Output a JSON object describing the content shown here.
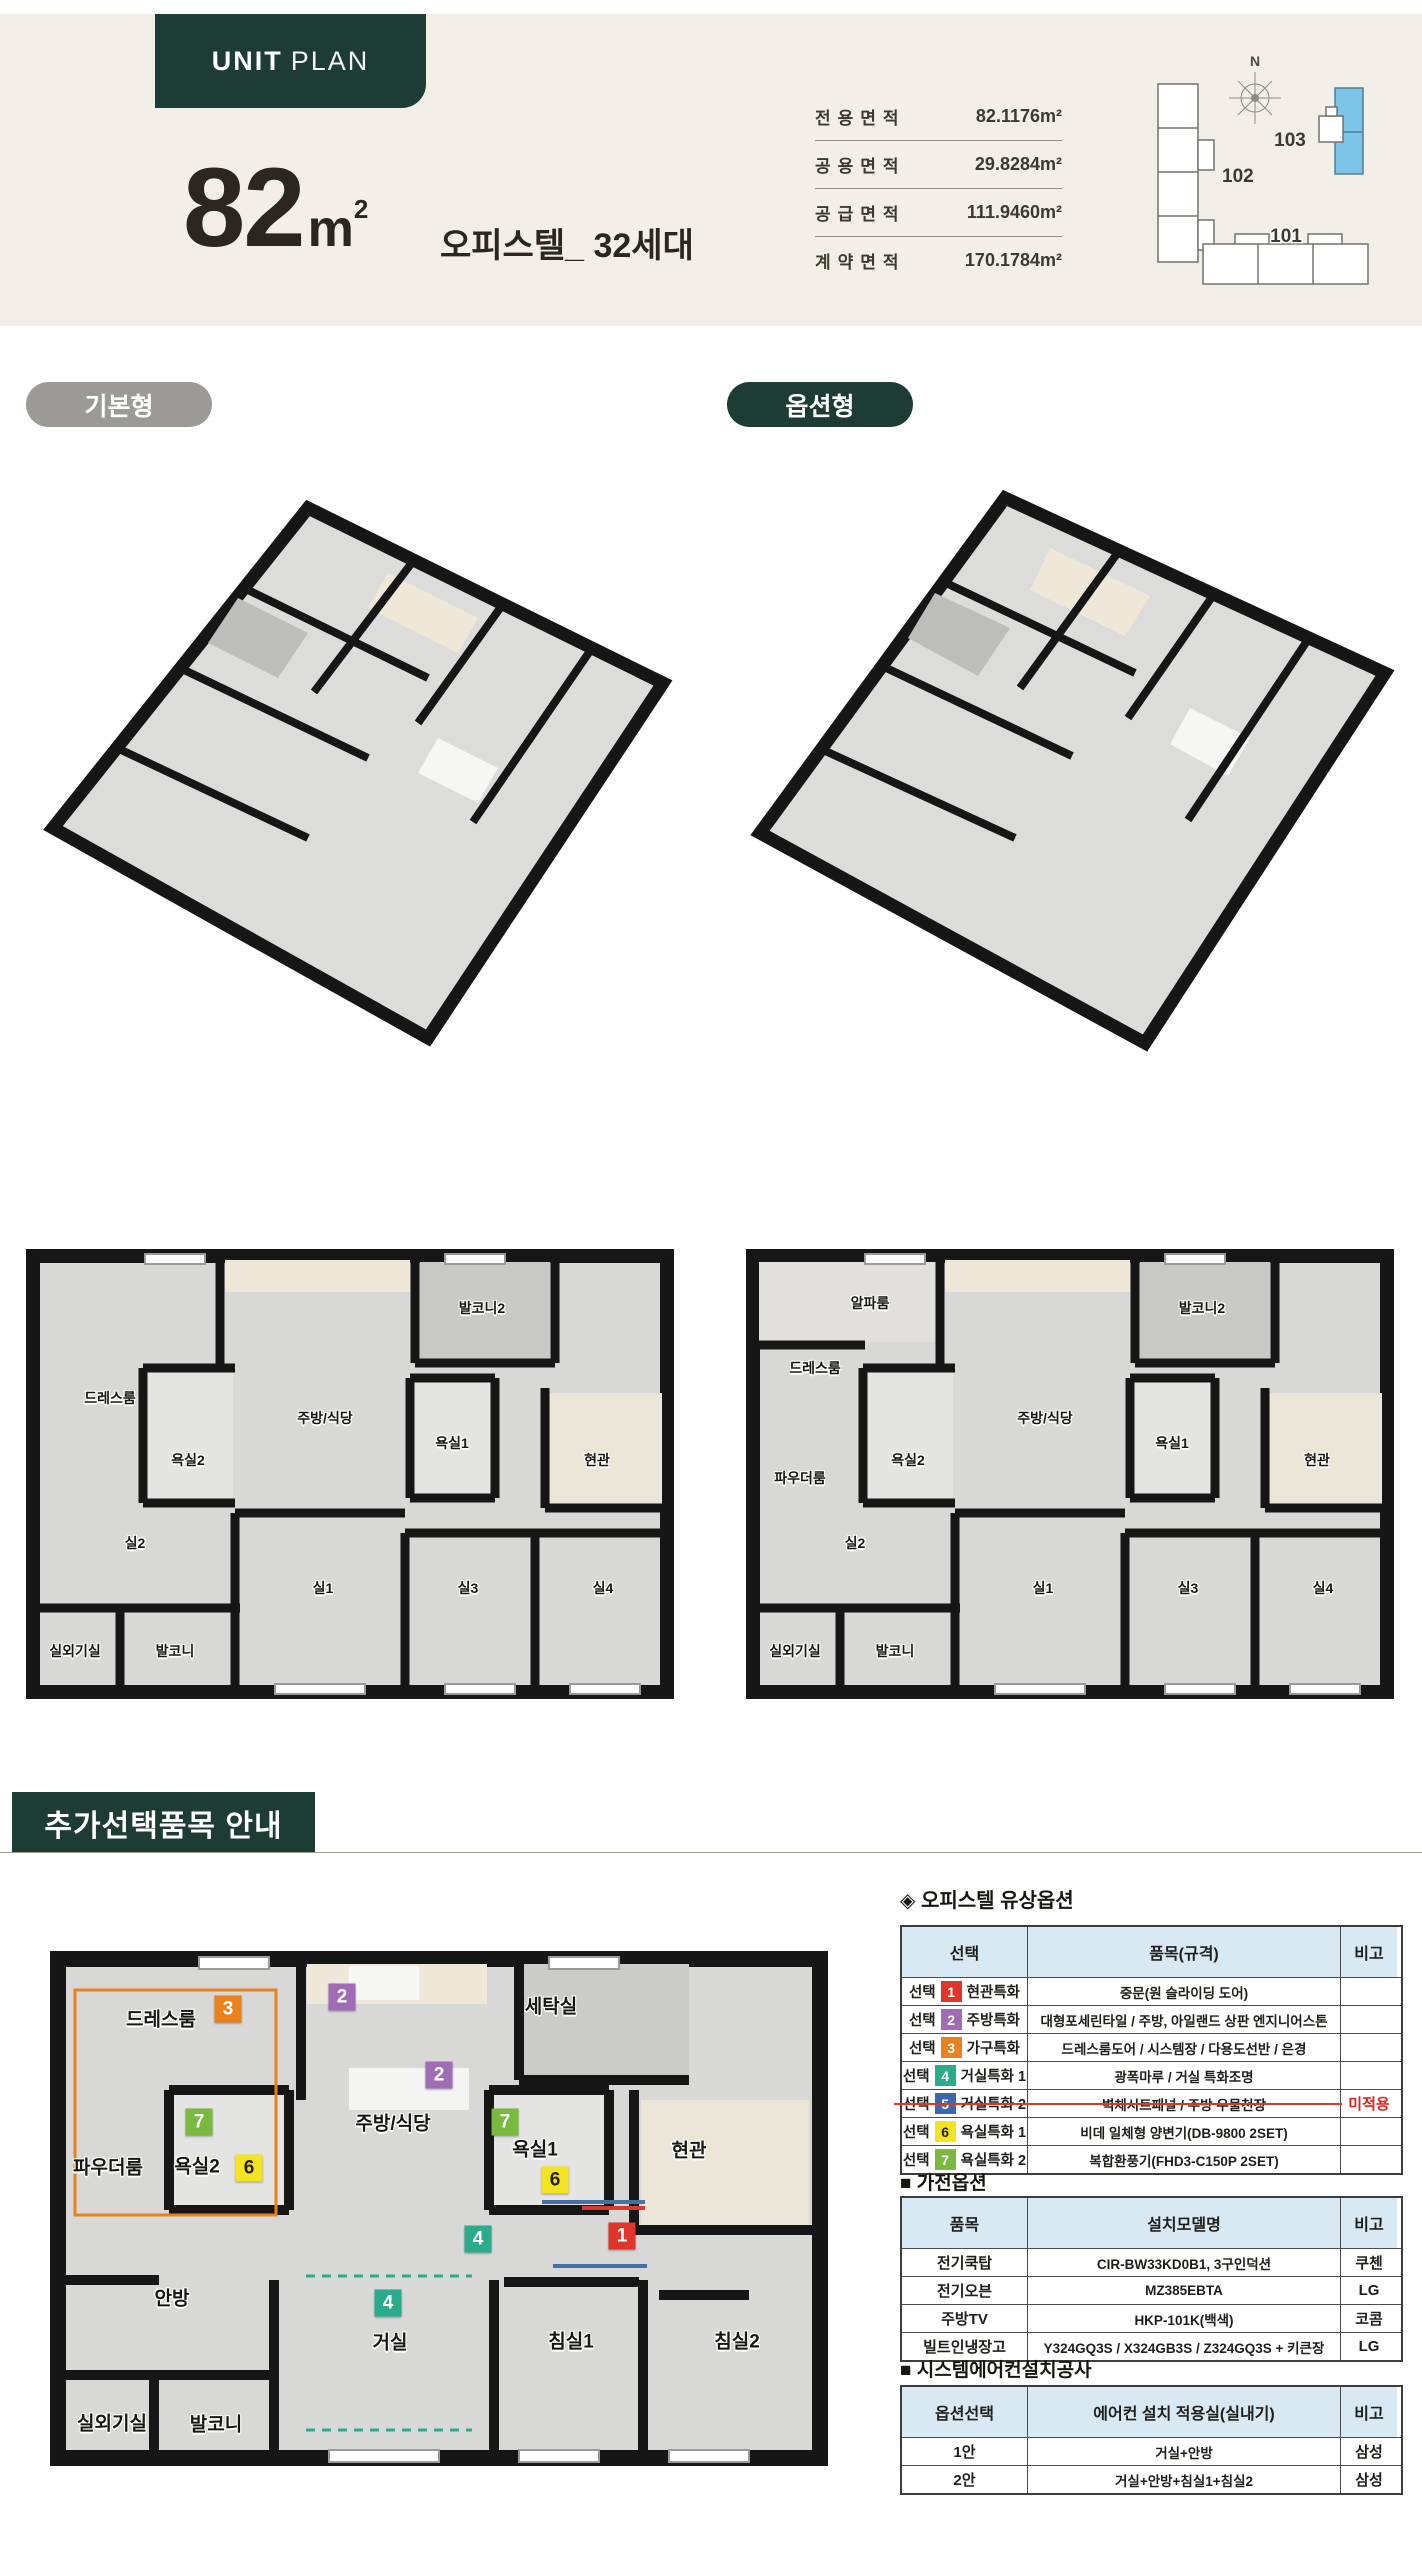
{
  "header": {
    "badge_bold": "UNIT",
    "badge_light": "PLAN",
    "size_number": "82",
    "size_unit": "m",
    "size_sup": "2",
    "subtitle": "오피스텔_ 32세대",
    "area_rows": [
      {
        "label": "전용면적",
        "value": "82.1176m²"
      },
      {
        "label": "공용면적",
        "value": "29.8284m²"
      },
      {
        "label": "공급면적",
        "value": "111.9460m²"
      },
      {
        "label": "계약면적",
        "value": "170.1784m²"
      }
    ],
    "site_map": {
      "north": "N",
      "b101": "101",
      "b102": "102",
      "b103": "103",
      "highlight_color": "#7cc5e8"
    }
  },
  "badges": {
    "basic": "기본형",
    "option": "옵션형"
  },
  "plan_basic": {
    "dress": "드레스룸",
    "balc2": "발코니2",
    "kitchen": "주방/식당",
    "bath2": "욕실2",
    "bath1": "욕실1",
    "entry": "현관",
    "r2": "실2",
    "r1": "실1",
    "r3": "실3",
    "r4": "실4",
    "ac": "실외기실",
    "balc": "발코니"
  },
  "plan_option": {
    "alpha": "알파룸",
    "dress": "드레스룸",
    "powder": "파우더룸",
    "balc2": "발코니2",
    "kitchen": "주방/식당",
    "bath2": "욕실2",
    "bath1": "욕실1",
    "entry": "현관",
    "r2": "실2",
    "r1": "실1",
    "r3": "실3",
    "r4": "실4",
    "ac": "실외기실",
    "balc": "발코니"
  },
  "section": {
    "title": "추가선택품목 안내"
  },
  "aplan": {
    "dress": "드레스룸",
    "laundry": "세탁실",
    "kitchen": "주방/식당",
    "powder": "파우더룸",
    "bath2": "욕실2",
    "bath1": "욕실1",
    "entry": "현관",
    "master": "안방",
    "living": "거실",
    "bed1": "침실1",
    "bed2": "침실2",
    "ac": "실외기실",
    "balc": "발코니",
    "m1": "1",
    "m2": "2",
    "m3": "3",
    "m4": "4",
    "m6": "6",
    "m7": "7"
  },
  "marker_colors": {
    "1": "#e0352b",
    "2": "#a06cb5",
    "3": "#e8821e",
    "4": "#2aab8a",
    "5": "#3a67ad",
    "6": "#f3e320",
    "7": "#79b93f"
  },
  "opt_table": {
    "title": "◈ 오피스텔 유상옵션",
    "col_sel": "선택",
    "col_item": "품목(규격)",
    "col_note": "비고",
    "rows": [
      {
        "prefix": "선택",
        "num": "1",
        "cat": "현관특화",
        "item": "중문(원 슬라이딩 도어)",
        "note": ""
      },
      {
        "prefix": "선택",
        "num": "2",
        "cat": "주방특화",
        "item": "대형포세린타일 / 주방, 아일랜드 상판 엔지니어스톤",
        "note": ""
      },
      {
        "prefix": "선택",
        "num": "3",
        "cat": "가구특화",
        "item": "드레스룸도어 / 시스템장 / 다용도선반 / 은경",
        "note": ""
      },
      {
        "prefix": "선택",
        "num": "4",
        "cat": "거실특화 1",
        "item": "광폭마루 / 거실 특화조명",
        "note": ""
      },
      {
        "prefix": "선택",
        "num": "5",
        "cat": "거실특화 2",
        "item": "벽체시트패널 / 주방 우물천장",
        "note": "미적용"
      },
      {
        "prefix": "선택",
        "num": "6",
        "cat": "욕실특화 1",
        "item": "비데 일체형 양변기(DB-9800 2SET)",
        "note": ""
      },
      {
        "prefix": "선택",
        "num": "7",
        "cat": "욕실특화 2",
        "item": "복합환풍기(FHD3-C150P 2SET)",
        "note": ""
      }
    ]
  },
  "appliance_table": {
    "title": "■ 가전옵션",
    "col_item": "품목",
    "col_model": "설치모델명",
    "col_note": "비고",
    "rows": [
      [
        "전기쿡탑",
        "CIR-BW33KD0B1, 3구인덕션",
        "쿠첸"
      ],
      [
        "전기오븐",
        "MZ385EBTA",
        "LG"
      ],
      [
        "주방TV",
        "HKP-101K(백색)",
        "코콤"
      ],
      [
        "빌트인냉장고",
        "Y324GQ3S / X324GB3S / Z324GQ3S + 키큰장",
        "LG"
      ]
    ]
  },
  "aircon_table": {
    "title": "■ 시스템에어컨설치공사",
    "col_sel": "옵션선택",
    "col_room": "에어컨 설치 적용실(실내기)",
    "col_note": "비고",
    "rows": [
      [
        "1안",
        "거실+안방",
        "삼성"
      ],
      [
        "2안",
        "거실+안방+침실1+침실2",
        "삼성"
      ]
    ]
  }
}
